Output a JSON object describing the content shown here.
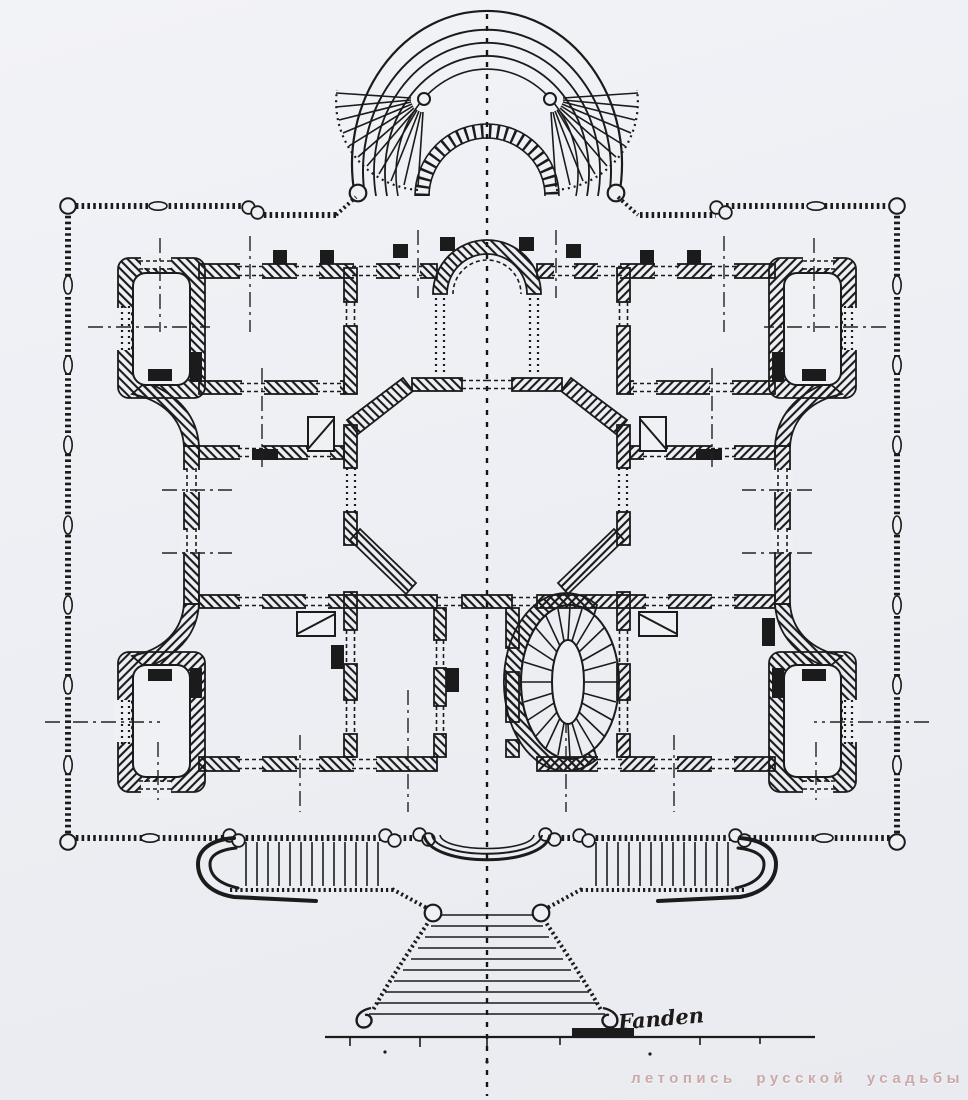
{
  "drawing": {
    "kind_label": "scanned architectural floor plan",
    "signature": "Fanden",
    "watermark": "летопись русской усадьбы"
  },
  "colors": {
    "paper": "#eef0f4",
    "ink": "#1b1b1b",
    "watermark_pink": "#c59a9a"
  },
  "icons": {
    "fan_staircase": "fan-staircase-icon",
    "oval_staircase": "oval-staircase-icon",
    "stove_symbol": "stove-diagonal-icon"
  }
}
